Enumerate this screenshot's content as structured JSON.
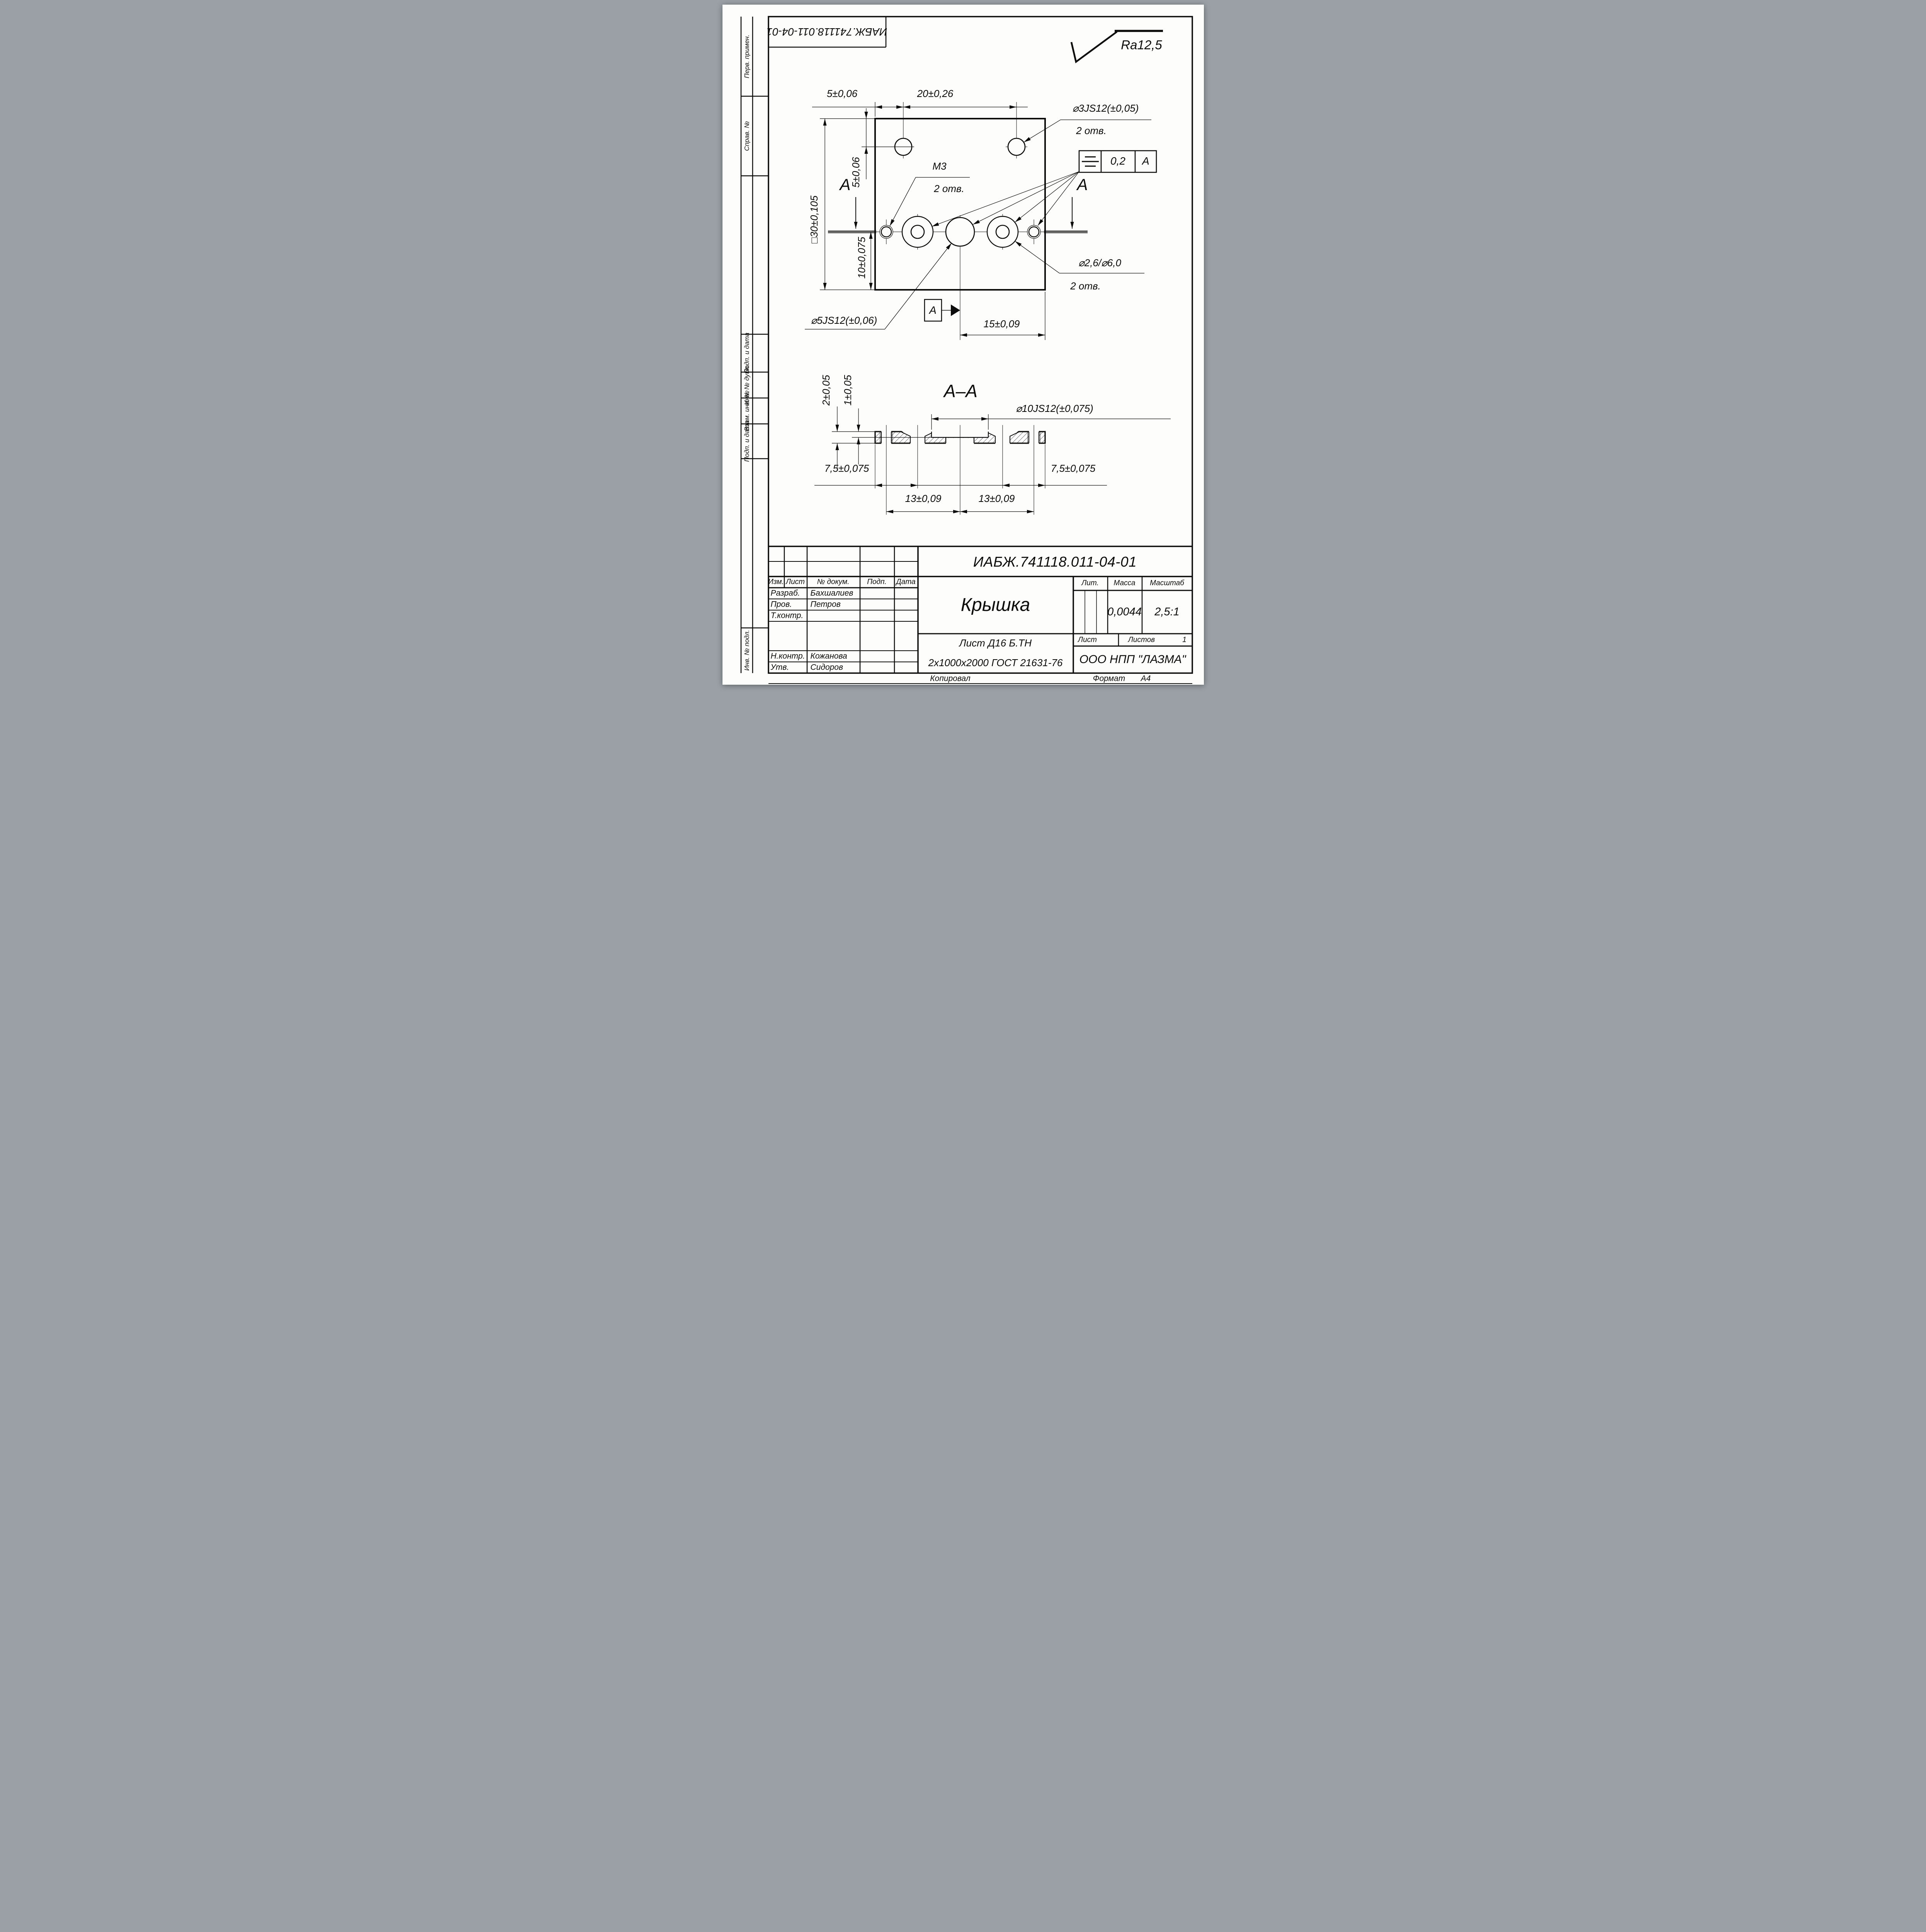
{
  "stamp_inverted": "ИАБЖ.741118.011-04-01",
  "roughness": {
    "label": "Ra12,5"
  },
  "margin": {
    "perv_primen": "Перв. примен.",
    "sprav_no": "Справ. №",
    "podp_data_1": "Подп. и дата",
    "inv_dubl": "Инв. № дубл.",
    "vzam_inv": "Взам. инв. №",
    "podp_data_2": "Подп. и дата",
    "inv_podl": "Инв. № подл."
  },
  "plan": {
    "dim_5_top": "5±0,06",
    "dim_20": "20±0,26",
    "hole3_line1": "⌀3JS12(±0,05)",
    "hole3_line2": "2 отв.",
    "m3_line1": "М3",
    "m3_line2": "2 отв.",
    "dim_30": "□30±0,105",
    "dim_5_left": "5±0,06",
    "dim_10": "10±0,075",
    "hole5": "⌀5JS12(±0,06)",
    "dim_15": "15±0,09",
    "hole26_line1": "⌀2,6/⌀6,0",
    "hole26_line2": "2 отв.",
    "tol_value": "0,2",
    "tol_datum": "A",
    "sec_letter_left": "A",
    "sec_letter_right": "A",
    "datum_flag": "A"
  },
  "section": {
    "title": "А–А",
    "dim_2": "2±0,05",
    "dim_1": "1±0,05",
    "dim_d10": "⌀10JS12(±0,075)",
    "dim_75_left": "7,5±0,075",
    "dim_75_right": "7,5±0,075",
    "dim_13_left": "13±0,09",
    "dim_13_right": "13±0,09"
  },
  "titleblock": {
    "number": "ИАБЖ.741118.011-04-01",
    "name": "Крышка",
    "material1": "Лист Д16 Б.ТН",
    "material2": "2х1000х2000 ГОСТ 21631-76",
    "company": "ООО НПП \"ЛАЗМА\"",
    "headers": {
      "izm": "Изм.",
      "list": "Лист",
      "doc": "№ докум.",
      "podp": "Подп.",
      "data": "Дата",
      "lit": "Лит.",
      "massa": "Масса",
      "masshtab": "Масштаб",
      "list2": "Лист",
      "listov": "Листов"
    },
    "values": {
      "massa": "0,0044",
      "masshtab": "2,5:1",
      "listov": "1"
    },
    "roles": [
      {
        "role": "Разраб.",
        "name": "Бахшалиев"
      },
      {
        "role": "Пров.",
        "name": "Петров"
      },
      {
        "role": "Т.контр.",
        "name": ""
      },
      {
        "role": "Н.контр.",
        "name": "Кожанова"
      },
      {
        "role": "Утв.",
        "name": "Сидоров"
      }
    ]
  },
  "footer": {
    "kopiroval": "Копировал",
    "format_label": "Формат",
    "format_value": "А4"
  }
}
